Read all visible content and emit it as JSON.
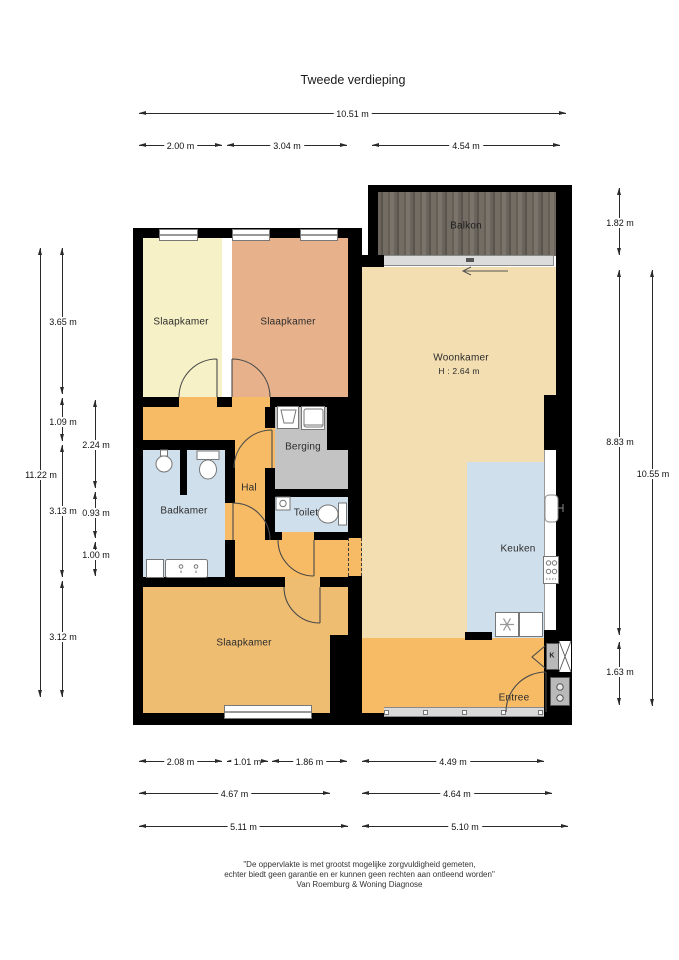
{
  "title": "Tweede verdieping",
  "footer": {
    "line1": "\"De oppervlakte is met grootst mogelijke zorgvuldigheid gemeten,",
    "line2": "echter biedt geen garantie en er kunnen geen rechten aan ontleend worden\"",
    "line3": "Van Roemburg & Woning Diagnose"
  },
  "rooms": {
    "slaapkamer1": {
      "label": "Slaapkamer"
    },
    "slaapkamer2": {
      "label": "Slaapkamer"
    },
    "slaapkamer3": {
      "label": "Slaapkamer"
    },
    "woonkamer": {
      "label": "Woonkamer",
      "height_note": "H : 2.64 m"
    },
    "balkon": {
      "label": "Balkon"
    },
    "berging": {
      "label": "Berging"
    },
    "hal": {
      "label": "Hal"
    },
    "badkamer": {
      "label": "Badkamer"
    },
    "toilet": {
      "label": "Toilet"
    },
    "keuken": {
      "label": "Keuken"
    },
    "entree": {
      "label": "Entree"
    },
    "kast": {
      "label": "K"
    }
  },
  "dims": {
    "top_total": "10.51 m",
    "top_a": "2.00 m",
    "top_b": "3.04 m",
    "top_c": "4.54 m",
    "left_total": "11.22 m",
    "left_a": "3.65 m",
    "left_b": "1.09 m",
    "left_c": "3.13 m",
    "left_d": "3.12 m",
    "left_ia": "2.24 m",
    "left_ib": "0.93 m",
    "left_ic": "1.00 m",
    "right_a": "1.82 m",
    "right_b": "8.83 m",
    "right_c": "1.63 m",
    "right_total": "10.55 m",
    "bot_r1a": "2.08 m",
    "bot_r1b": "1.01 m",
    "bot_r1c": "1.86 m",
    "bot_r1d": "4.49 m",
    "bot_r2a": "4.67 m",
    "bot_r2b": "4.64 m",
    "bot_r3a": "5.11 m",
    "bot_r3b": "5.10 m"
  },
  "colors": {
    "wall": "#000000",
    "bedroom_yellow": "#f6f1c6",
    "bedroom_salmon": "#e7b28b",
    "bedroom_orange": "#eebd72",
    "living_tan": "#f3deb1",
    "hall_orange": "#f6bb64",
    "wet_blue": "#cfdfec",
    "storage_gray": "#c3c3c3",
    "balcony_wood": "#6a645c"
  }
}
